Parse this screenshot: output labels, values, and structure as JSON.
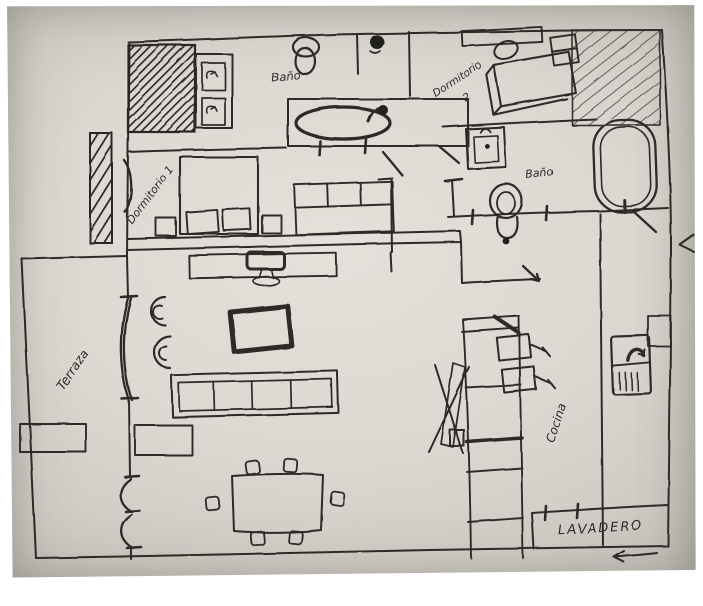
{
  "palette": {
    "page_bg": "#ffffff",
    "paper": "#d9d6cf",
    "paper_edge": "#b5b2ab",
    "ink": "#2d2b28"
  },
  "rooms": {
    "bano_top": {
      "label": "Baño"
    },
    "dormitorio_1": {
      "label": "Dormitorio 1"
    },
    "dormitorio_2": {
      "label": "Dormitorio",
      "number": "2"
    },
    "bano_right": {
      "label": "Baño"
    },
    "terraza": {
      "label": "Terraza"
    },
    "cocina": {
      "label": "Cocina"
    },
    "lavadero": {
      "label": "Lavadero"
    }
  }
}
